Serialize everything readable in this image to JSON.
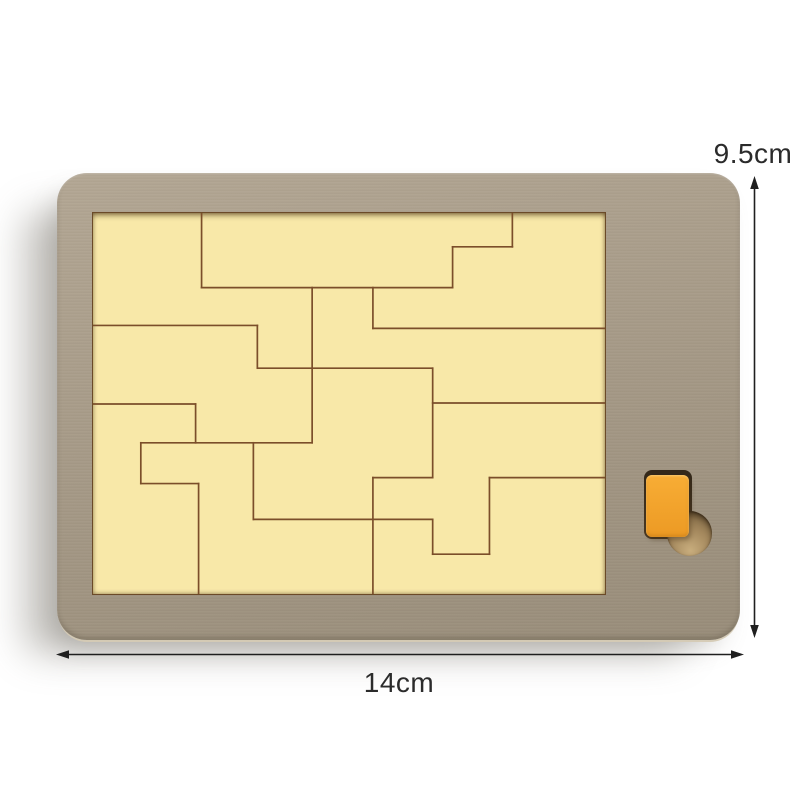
{
  "annotations": {
    "height_label": "9.5cm",
    "width_label": "14cm"
  },
  "colors": {
    "background": "#ffffff",
    "frame_light": "#b3a794",
    "frame_mid": "#a79b88",
    "frame_dark": "#998d7a",
    "tray_fill": "#f8e8a8",
    "tray_edge": "#6b4a28",
    "piece_line": "#7b4e2a",
    "slot_recess": "#4a3a26",
    "piece_orange": "#f8ad35",
    "piece_orange_deep": "#ec9a24",
    "hole_wood": "#a5895e",
    "hole_wood_dark": "#6e5939",
    "hole_wood_light": "#c8ad7d",
    "dimension": "#1f1f1f",
    "label_text": "#2b2b2b"
  },
  "puzzle": {
    "tray_viewbox": "0 0 514 383",
    "segments": [
      [
        109,
        0,
        109,
        75
      ],
      [
        109,
        75,
        361,
        75
      ],
      [
        361,
        34,
        361,
        75
      ],
      [
        361,
        34,
        421,
        34
      ],
      [
        421,
        0,
        421,
        34
      ],
      [
        220,
        75,
        220,
        231
      ],
      [
        281,
        75,
        281,
        116
      ],
      [
        281,
        116,
        514,
        116
      ],
      [
        0,
        113,
        165,
        113
      ],
      [
        165,
        113,
        165,
        156
      ],
      [
        165,
        156,
        341,
        156
      ],
      [
        341,
        156,
        341,
        266
      ],
      [
        341,
        191,
        514,
        191
      ],
      [
        0,
        192,
        103,
        192
      ],
      [
        103,
        192,
        103,
        231
      ],
      [
        48,
        231,
        220,
        231
      ],
      [
        48,
        231,
        48,
        272
      ],
      [
        48,
        272,
        106,
        272
      ],
      [
        106,
        272,
        106,
        383
      ],
      [
        161,
        231,
        161,
        308
      ],
      [
        161,
        308,
        341,
        308
      ],
      [
        341,
        308,
        341,
        343
      ],
      [
        341,
        343,
        398,
        343
      ],
      [
        398,
        266,
        398,
        343
      ],
      [
        281,
        266,
        341,
        266
      ],
      [
        398,
        266,
        514,
        266
      ],
      [
        281,
        266,
        281,
        383
      ]
    ]
  }
}
